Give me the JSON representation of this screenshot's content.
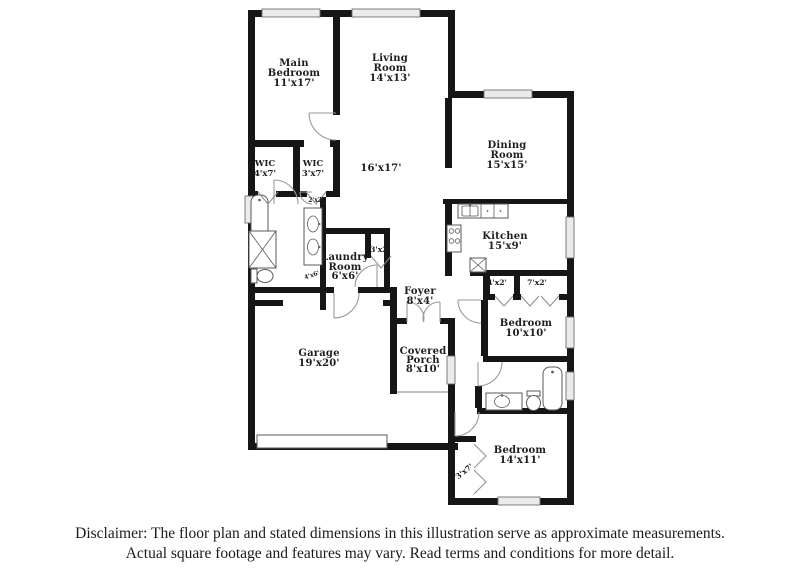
{
  "disclaimer": {
    "line1": "Disclaimer: The floor plan and stated dimensions in this illustration serve as approximate measurements.",
    "line2": "Actual square footage and features may vary. Read terms and conditions for more detail."
  },
  "rooms": {
    "main_bedroom": {
      "name": "Main Bedroom",
      "dims": "11'x17'",
      "lines": [
        "Main",
        "Bedroom",
        "11'x17'"
      ]
    },
    "living_room": {
      "name": "Living Room",
      "dims": "14'x13'",
      "lines": [
        "Living",
        "Room",
        "14'x13'"
      ]
    },
    "wic_left": {
      "name": "WIC",
      "dims": "4'x7'",
      "lines": [
        "WIC",
        "4'x7'"
      ]
    },
    "wic_right": {
      "name": "WIC",
      "dims": "3'x7'",
      "lines": [
        "WIC",
        "3'x7'"
      ]
    },
    "great_room": {
      "name": "",
      "dims": "16'x17'",
      "lines": [
        "16'x17'"
      ]
    },
    "dining_room": {
      "name": "Dining Room",
      "dims": "15'x15'",
      "lines": [
        "Dining",
        "Room",
        "15'x15'"
      ]
    },
    "kitchen": {
      "name": "Kitchen",
      "dims": "15'x9'",
      "lines": [
        "Kitchen",
        "15'x9'"
      ]
    },
    "laundry_room": {
      "name": "Laundry Room",
      "dims": "6'x6'",
      "lines": [
        "Laundry",
        "Room",
        "6'x6'"
      ]
    },
    "foyer": {
      "name": "Foyer",
      "dims": "8'x4'",
      "lines": [
        "Foyer",
        "8'x4'"
      ]
    },
    "garage": {
      "name": "Garage",
      "dims": "19'x20'",
      "lines": [
        "Garage",
        "19'x20'"
      ]
    },
    "covered_porch": {
      "name": "Covered Porch",
      "dims": "8'x10'",
      "lines": [
        "Covered",
        "Porch",
        "8'x10'"
      ]
    },
    "bedroom_2": {
      "name": "Bedroom",
      "dims": "10'x10'",
      "lines": [
        "Bedroom",
        "10'x10'"
      ]
    },
    "bedroom_3": {
      "name": "Bedroom",
      "dims": "14'x11'",
      "lines": [
        "Bedroom",
        "14'x11'"
      ]
    }
  },
  "small_labels": {
    "laundry_closet": "3'x2'",
    "bedroom2_closet_small": "4'x2'",
    "bedroom2_closet_large": "7'x2'",
    "bedroom3_closet": "3'x7'",
    "vanity_closet": "2'x2'",
    "hall_nook": "4'x6'"
  },
  "fixtures": [
    "bathtub",
    "shower",
    "toilet",
    "double-vanity",
    "kitchen-sink",
    "stove",
    "pantry",
    "garage-door",
    "french-doors",
    "windows",
    "bifold-closet-doors"
  ],
  "colors": {
    "wall": "#161616",
    "window_fill": "#eceaea",
    "fixture_stroke": "#5a5a5a",
    "door_arc": "#9a9a9a",
    "text": "#1e1e1e",
    "background": "#ffffff"
  }
}
